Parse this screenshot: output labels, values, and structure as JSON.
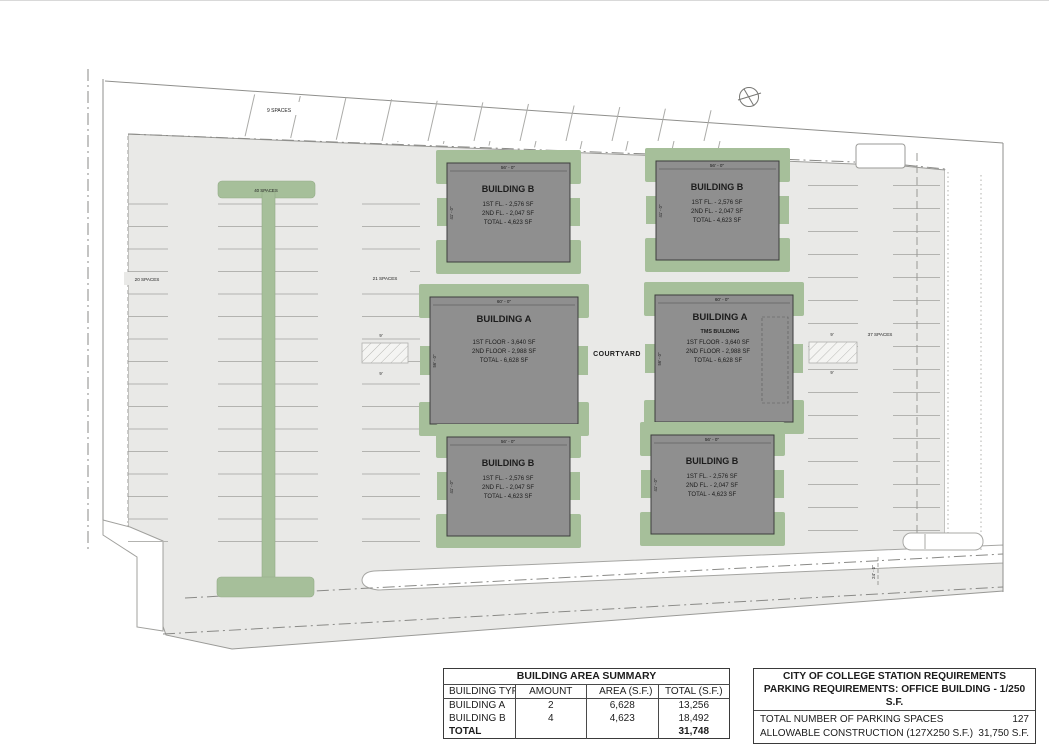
{
  "colors": {
    "lot_gray": "#e9e9e7",
    "landscape_green": "#a6bf9a",
    "building_gray": "#8f8f8f",
    "line_gray": "#9a9a97",
    "text_dark": "#1c1c1c"
  },
  "plan": {
    "courtyard_label": "COURTYARD",
    "parking_labels": {
      "top_row": "9 SPACES",
      "west_edge": "20 SPACES",
      "west_island": "40 SPACES",
      "west_inner": "21 SPACES",
      "east_row": "37 SPACES"
    },
    "dims": {
      "stall_width_west": "9'",
      "stall_width_west_2": "9'",
      "stall_width_east": "9'",
      "stall_width_east_2": "9'",
      "aisle_width": "24' - 0\""
    }
  },
  "buildings": [
    {
      "name": "BUILDING B",
      "subtitle": "",
      "line1": "1ST FL.  -  2,576 SF",
      "line2": "2ND FL. - 2,047 SF",
      "line3": "TOTAL   -  4,623 SF",
      "width_dim": "56' - 0\"",
      "depth_dim": "41' - 0\""
    },
    {
      "name": "BUILDING B",
      "subtitle": "",
      "line1": "1ST FL.  -  2,576 SF",
      "line2": "2ND FL. - 2,047 SF",
      "line3": "TOTAL   -  4,623 SF",
      "width_dim": "56' - 0\"",
      "depth_dim": "41' - 0\""
    },
    {
      "name": "BUILDING A",
      "subtitle": "",
      "line1": "1ST FLOOR   -  3,640 SF",
      "line2": "2ND FLOOR  -  2,988 SF",
      "line3": "TOTAL   -       6,628 SF",
      "width_dim": "60' - 0\"",
      "depth_dim": "56' - 0\""
    },
    {
      "name": "BUILDING A",
      "subtitle": "TMS BUILDING",
      "line1": "1ST FLOOR   -  3,640 SF",
      "line2": "2ND FLOOR  -  2,988 SF",
      "line3": "TOTAL   -       6,628 SF",
      "width_dim": "60' - 0\"",
      "depth_dim": "56' - 0\""
    },
    {
      "name": "BUILDING B",
      "subtitle": "",
      "line1": "1ST FL.  -  2,576 SF",
      "line2": "2ND FL. - 2,047 SF",
      "line3": "TOTAL   -  4,623 SF",
      "width_dim": "56' - 0\"",
      "depth_dim": "41' - 0\""
    },
    {
      "name": "BUILDING B",
      "subtitle": "",
      "line1": "1ST FL.  -  2,576 SF",
      "line2": "2ND FL. - 2,047 SF",
      "line3": "TOTAL   -  4,623 SF",
      "width_dim": "56' - 0\"",
      "depth_dim": "41' - 0\""
    }
  ],
  "summary_table": {
    "title": "BUILDING AREA SUMMARY",
    "headers": [
      "BUILDING TYPE",
      "AMOUNT",
      "AREA (S.F.)",
      "TOTAL (S.F.)"
    ],
    "rows": [
      [
        "BUILDING A",
        "2",
        "6,628",
        "13,256"
      ],
      [
        "BUILDING B",
        "4",
        "4,623",
        "18,492"
      ]
    ],
    "total_label": "TOTAL",
    "total_value": "31,748"
  },
  "requirements_table": {
    "title1": "CITY OF COLLEGE STATION REQUIREMENTS",
    "title2": "PARKING REQUIREMENTS: OFFICE BUILDING - 1/250 S.F.",
    "rows": [
      [
        "TOTAL NUMBER OF PARKING SPACES",
        "127"
      ],
      [
        "ALLOWABLE CONSTRUCTION (127X250 S.F.)",
        "31,750 S.F."
      ]
    ]
  }
}
